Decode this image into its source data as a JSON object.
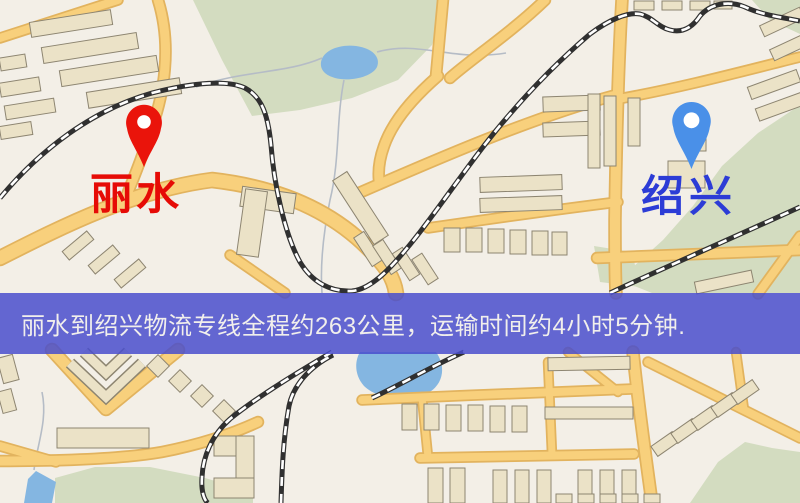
{
  "banner": {
    "text": "丽水到绍兴物流专线全程约263公里，运输时间约4小时5分钟.",
    "background_color": "#494ecd",
    "text_color": "#f1efec"
  },
  "markers": [
    {
      "name": "丽水",
      "pin": "red-location-pin",
      "pin_color": "#ea140b",
      "label_color": "#e60b06"
    },
    {
      "name": "绍兴",
      "pin": "blue-location-pin",
      "pin_color": "#4a90e8",
      "label_color": "#2c3cd6"
    }
  ],
  "map_colors": {
    "background": "#f3efe7",
    "road": "#f8d07c",
    "road_casing": "#e2b35e",
    "park": "#d3dcc0",
    "water": "#84b6e1",
    "building_fill": "#ebe2c7",
    "building_stroke": "#8d8571",
    "railway_dark": "#303030",
    "railway_dash": "#ffffff",
    "stream": "#b5bcc6"
  }
}
